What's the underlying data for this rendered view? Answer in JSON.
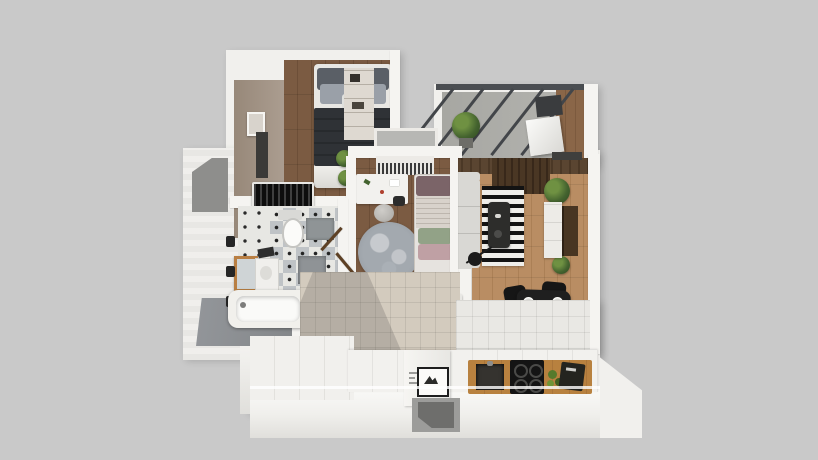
{
  "scene": {
    "kind": "3d-floor-plan-render",
    "view": "top-down isometric apartment visualization",
    "background_color": "#c9c9c9"
  },
  "palette": {
    "backdrop_gray": "#c9c9c9",
    "wall_white": "#f1f0ed",
    "wall_face_white": "#fafaf8",
    "accent_wall_taupe": "#a29282",
    "bedroom_floor_wood_dark": "#755640",
    "living_floor_wood_light": "#b68a60",
    "balcony_concrete": "#b1b1ac",
    "balcony_rail_dark": "#43464a",
    "hall_tile_beige": "#d3cbbe",
    "kitchen_tile_white": "#e9e8e4",
    "bath_checker_gray": "#bfc3c6",
    "bath_shower_gray": "#8b8e90",
    "dark_furniture": "#161616",
    "bed_blanket_charcoal": "#2f3236",
    "sofa_gray": "#d9d8d4",
    "rug_stripe_dark": "#131313",
    "rug_stripe_light": "#efeeea",
    "round_rug_gray": "#9aa0a6",
    "plant_green": "#44632f",
    "counter_wood": "#b8813f",
    "mirror_frame_wood": "#b97f43",
    "tv_panel_brown": "#483522",
    "kid_pillow_green": "#92a287",
    "kid_pillow_pink": "#bfa0a4",
    "dining_flower_orange": "#d2691e"
  },
  "rooms": [
    {
      "id": "master-bedroom",
      "furniture": [
        "double-bed",
        "gray-pillows",
        "charcoal-blanket",
        "wardrobe",
        "accent-wall",
        "framed-picture",
        "wall-tv",
        "potted-plants",
        "slatted-dresser"
      ]
    },
    {
      "id": "balcony",
      "furniture": [
        "railing-struts",
        "potted-shrub",
        "ac-unit-box",
        "storage-box"
      ]
    },
    {
      "id": "living-room",
      "furniture": [
        "sofa",
        "striped-rug",
        "coffee-table",
        "arc-floor-lamp",
        "tv-cabinet",
        "wall-tv-panel",
        "plants",
        "dining-table",
        "four-chairs",
        "plates",
        "flower-centerpiece",
        "window-blinds"
      ]
    },
    {
      "id": "kids-room",
      "furniture": [
        "window",
        "slatted-sideboard",
        "desk",
        "desk-chair",
        "stool",
        "round-rug",
        "single-bed",
        "striped-blanket",
        "green-pillow",
        "pink-pillow",
        "plant",
        "hall-radiators"
      ]
    },
    {
      "id": "bathroom",
      "furniture": [
        "toilet",
        "shower-mats",
        "vanity-mirror",
        "sink",
        "towel",
        "bathtub",
        "wall-hooks",
        "checker-tile-floor",
        "shower-gray-floor"
      ]
    },
    {
      "id": "hallway",
      "furniture": [
        "beige-tile-floor",
        "radiator-covers"
      ]
    },
    {
      "id": "kitchen",
      "furniture": [
        "counter",
        "wood-counter-inset",
        "sink",
        "stove-four-burners",
        "vegetables",
        "cutting-board",
        "fridge-top",
        "framed-art",
        "wall-niche"
      ]
    }
  ]
}
